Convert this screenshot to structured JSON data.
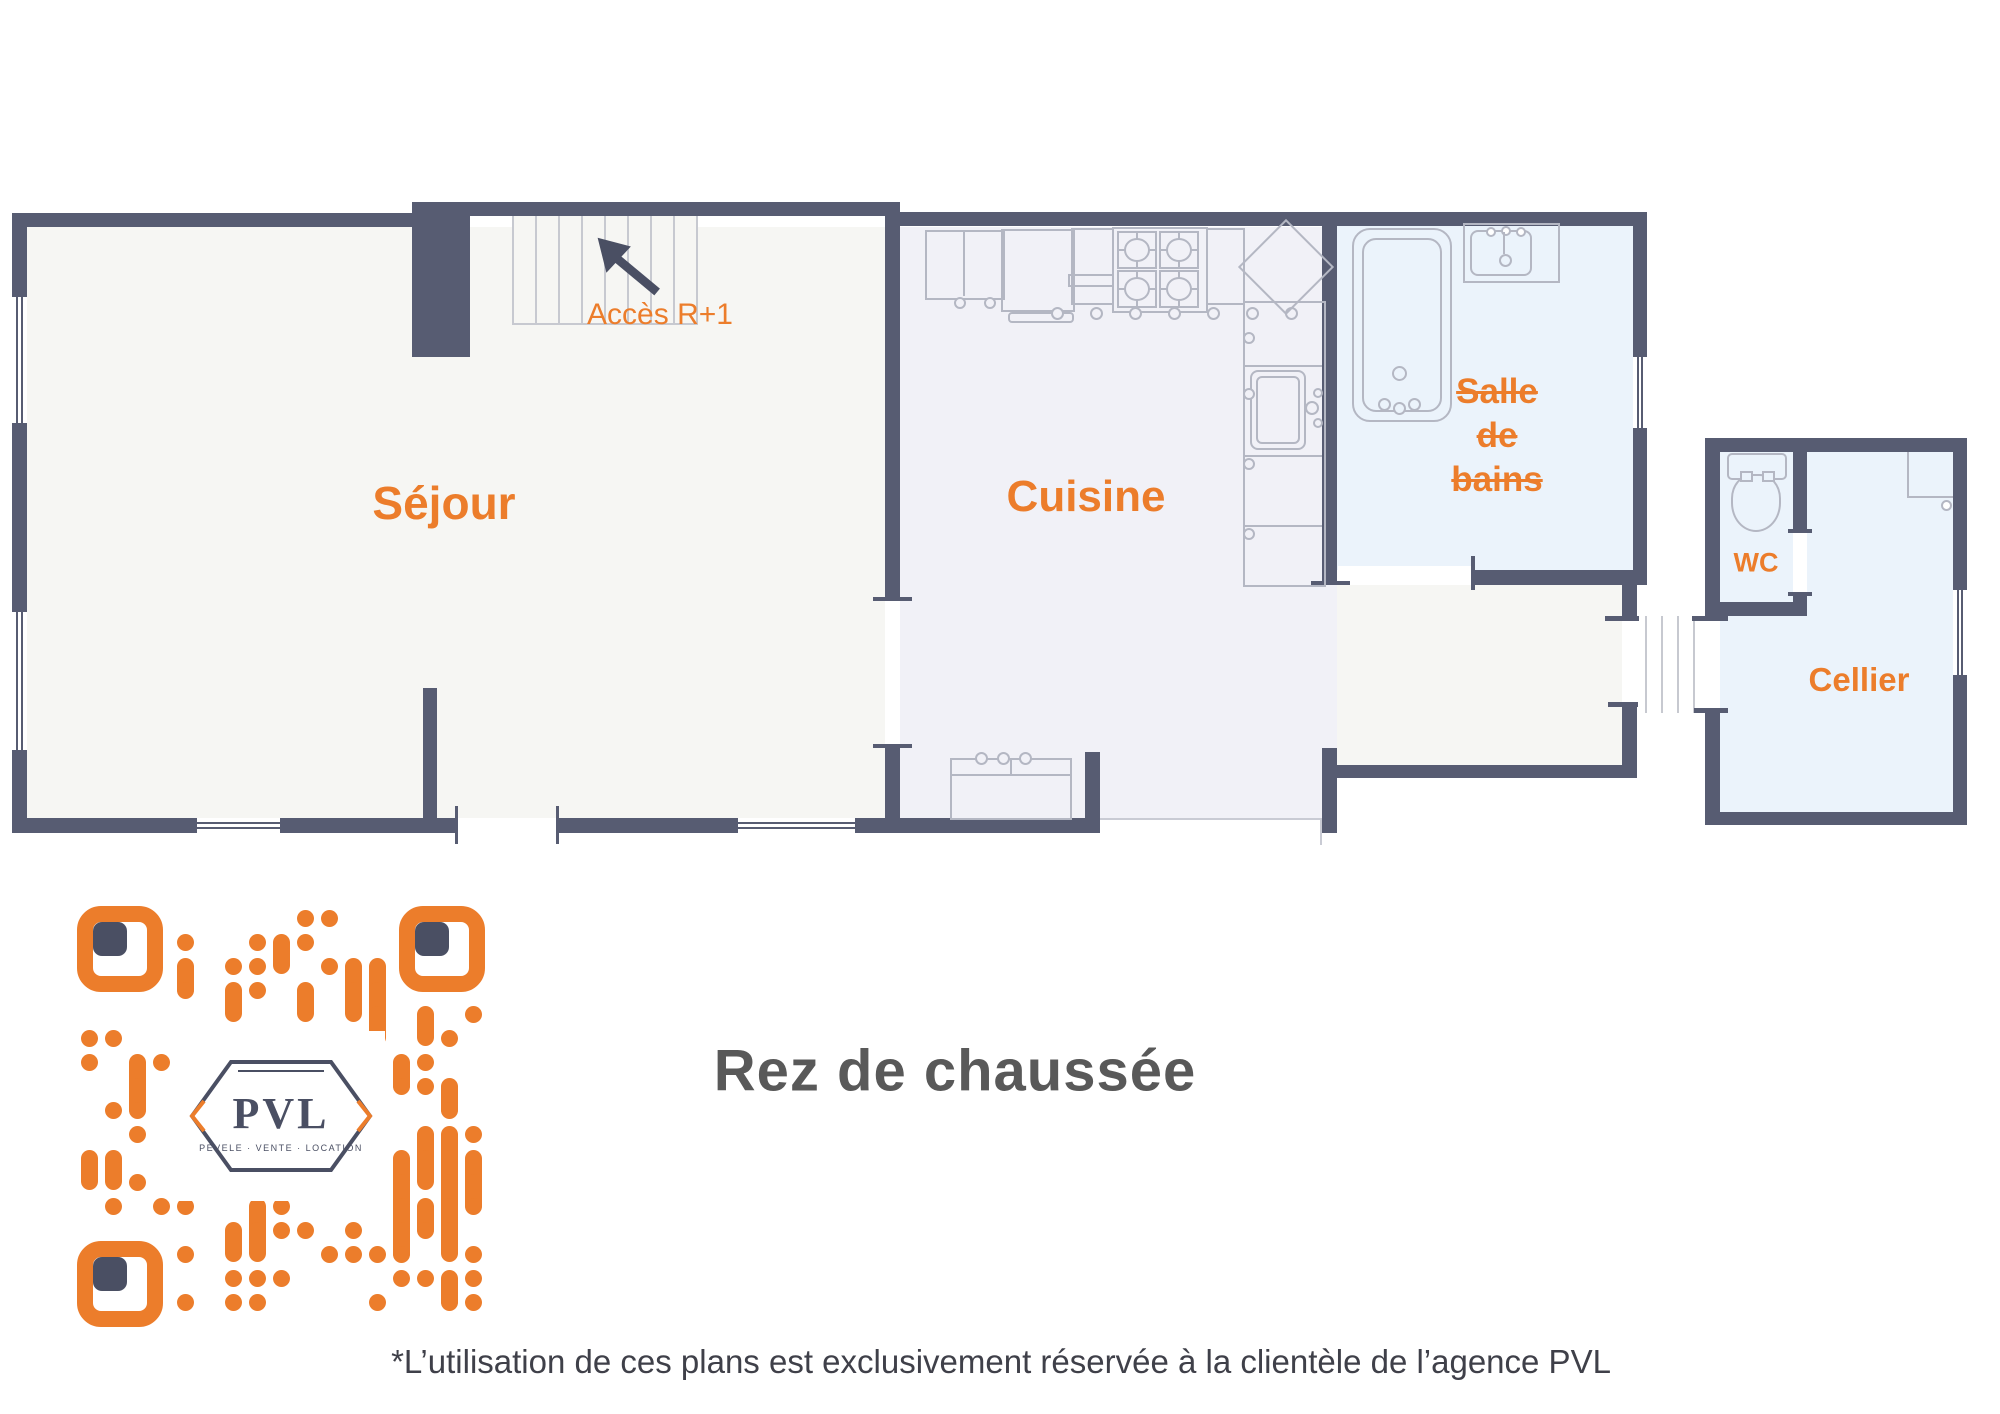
{
  "title": "Rez de chaussée",
  "rooms": {
    "sejour": {
      "label": "Séjour"
    },
    "cuisine": {
      "label": "Cuisine"
    },
    "salle_de_bains": {
      "label_line1": "Salle",
      "label_line2": "de",
      "label_line3": "bains"
    },
    "wc": {
      "label": "WC"
    },
    "cellier": {
      "label": "Cellier"
    }
  },
  "annotations": {
    "stairs_access": "Accès R+1"
  },
  "footer": {
    "disclaimer": "*L’utilisation de ces plans est exclusivement réservée à la clientèle de l’agence PVL"
  },
  "logo": {
    "name": "PVL",
    "caption": "PEVELE · VENTE · LOCATION"
  },
  "theme": {
    "wall": "#575C72",
    "floor_main": "#F6F6F3",
    "floor_kitchen": "#F1F1F7",
    "floor_wet": "#EBF3FB",
    "furn": "#B4B7C3",
    "accent": "#EC7D2B",
    "title_color": "#595959",
    "text_color": "#3F4049",
    "stair_line": "#C7C9D0",
    "logo_dark": "#4A4F63"
  }
}
